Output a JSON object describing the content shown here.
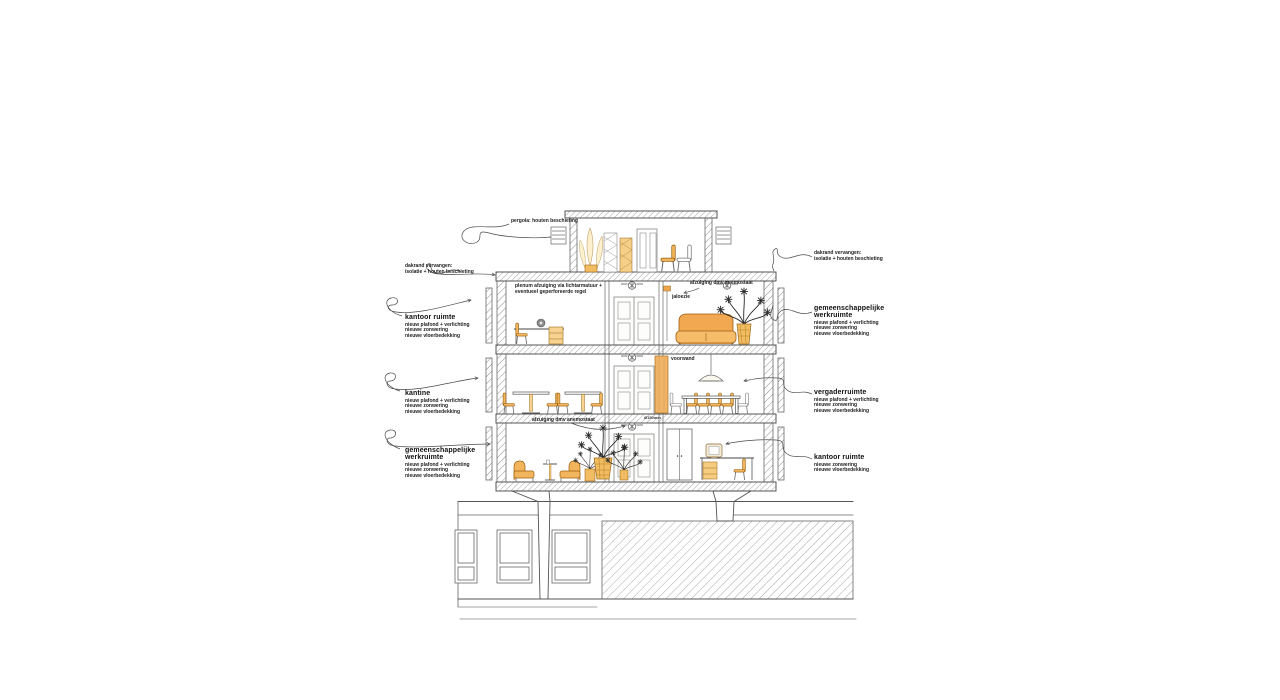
{
  "annotations": {
    "pergola": "pergola: houten beschieting",
    "roof_left_1": "dakrand vervangen:",
    "roof_left_2": "isolatie + houten beschieting",
    "roof_right_1": "dakrand vervangen:",
    "roof_right_2": "isolatie + houten beschieting",
    "plenum_1": "plenum afzuiging via lichtarmatuur +",
    "plenum_2": "eventueel geperforeerde regel",
    "extract_top": "afzuiging dmv anemostaat",
    "blind": "jaloezie",
    "front_wall": "voorwand",
    "extract_bottom": "afzuiging dmv anemostaat",
    "duct_size": "Ø150mm"
  },
  "rooms": {
    "office_top_left": {
      "title": "kantoor ruimte",
      "notes": [
        "nieuw plafond + verlichting",
        "nieuwe zonwering",
        "nieuwe vloerbedekking"
      ]
    },
    "shared_top_right": {
      "title": "gemeenschappelijke werkruimte",
      "notes": [
        "nieuw plafond + verlichting",
        "nieuwe zonwering",
        "nieuwe vloerbedekking"
      ]
    },
    "canteen": {
      "title": "kantine",
      "notes": [
        "nieuw plafond + verlichting",
        "nieuwe zonwering",
        "nieuwe vloerbedekking"
      ]
    },
    "meeting": {
      "title": "vergaderruimte",
      "notes": [
        "nieuw plafond + verlichting",
        "nieuwe zonwering",
        "nieuwe vloerbedekking"
      ]
    },
    "shared_bottom_left": {
      "title": "gemeenschappelijke werkruimte",
      "notes": [
        "nieuw plafond + verlichting",
        "nieuwe zonwering",
        "nieuwe vloerbedekking"
      ]
    },
    "office_bottom_right": {
      "title": "kantoor ruimte",
      "notes": [
        "nieuwe zonwering",
        "nieuwe vloerbedekking"
      ]
    }
  },
  "colors": {
    "furniture": "#f2b45c",
    "wood_panel": "#f0b469",
    "line": "#444444"
  }
}
